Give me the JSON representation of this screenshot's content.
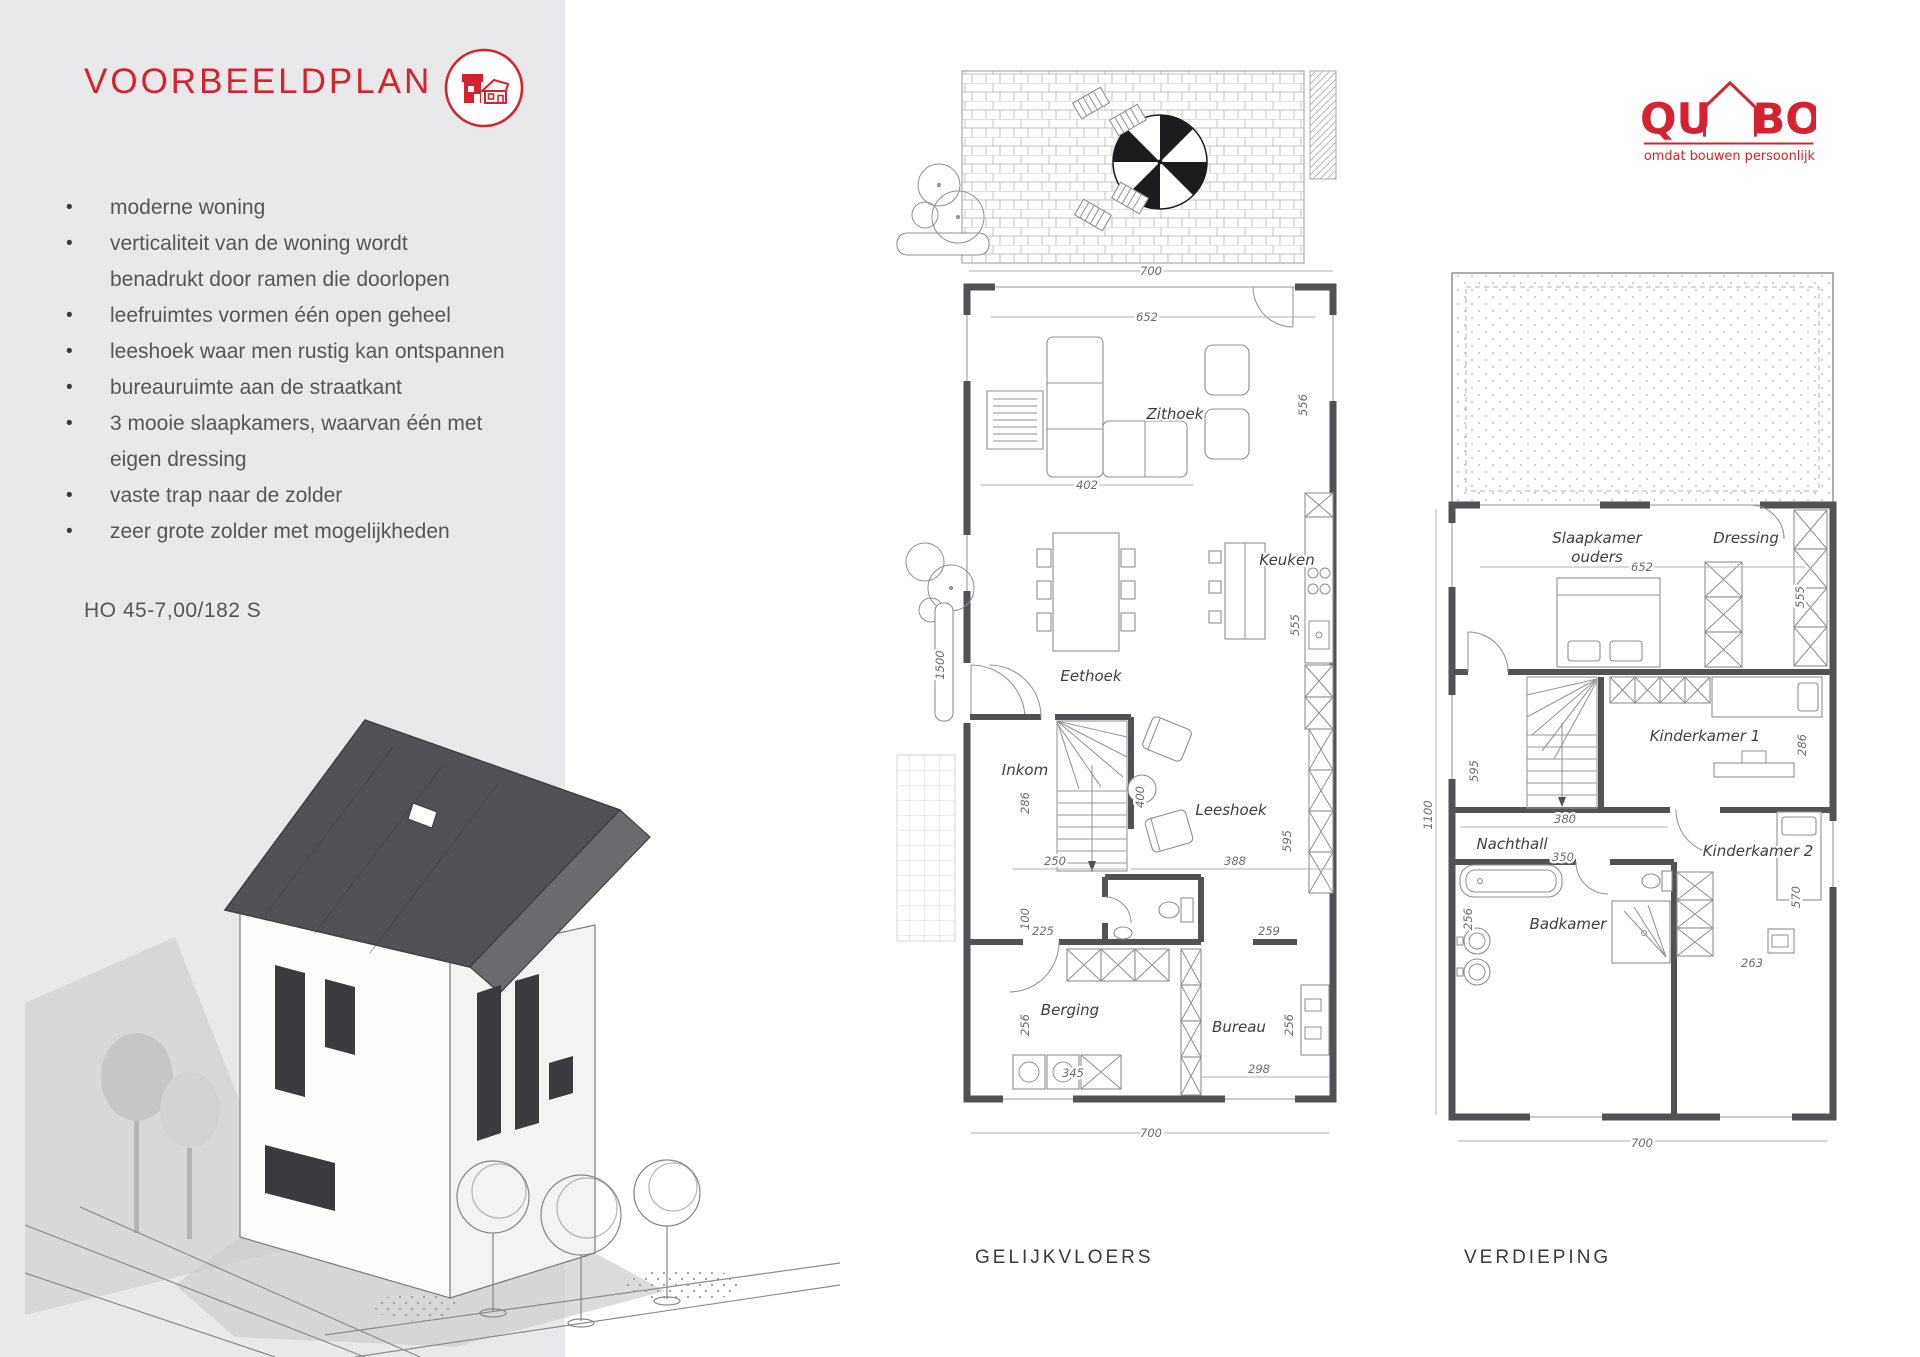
{
  "panel": {
    "title": "VOORBEELDPLAN",
    "lines": [
      {
        "bullet": "•",
        "text": "moderne woning"
      },
      {
        "bullet": "•",
        "text": "verticaliteit van de woning wordt"
      },
      {
        "bullet": "",
        "text": "benadrukt door ramen die doorlopen"
      },
      {
        "bullet": "•",
        "text": "leefruimtes vormen één open geheel"
      },
      {
        "bullet": "•",
        "text": "leeshoek waar men rustig kan ontspannen"
      },
      {
        "bullet": "•",
        "text": "bureauruimte aan de straatkant"
      },
      {
        "bullet": "•",
        "text": "3 mooie slaapkamers, waarvan één met"
      },
      {
        "bullet": "",
        "text": "eigen dressing"
      },
      {
        "bullet": "•",
        "text": "vaste trap naar de zolder"
      },
      {
        "bullet": "•",
        "text": "zeer grote zolder met mogelijkheden"
      }
    ],
    "code": "HO 45-7,00/182 S"
  },
  "logo": {
    "qu": "QU",
    "bo": "BO",
    "tagline": "omdat bouwen persoonlijk is"
  },
  "plans": {
    "ground": {
      "caption": "GELIJKVLOERS",
      "rooms": {
        "zithoek": "Zithoek",
        "keuken": "Keuken",
        "eethoek": "Eethoek",
        "inkom": "Inkom",
        "leeshoek": "Leeshoek",
        "berging": "Berging",
        "bureau": "Bureau"
      },
      "dims": {
        "terras": "700",
        "top": "652",
        "zithoek_d": "556",
        "sofa": "402",
        "keuken_d": "555",
        "oprit": "1500",
        "inkom_d": "286",
        "trap": "250",
        "gang": "100",
        "hal": "225",
        "leeshoek_w": "388",
        "wc": "259",
        "leeshoek_d": "595",
        "tafel": "400",
        "berging_d": "256",
        "was": "345",
        "bureau_d": "256",
        "bureau_w": "298",
        "breedte": "700"
      }
    },
    "upper": {
      "caption": "VERDIEPING",
      "rooms": {
        "slaapkamer_1": "Slaapkamer",
        "slaapkamer_2": "ouders",
        "dressing": "Dressing",
        "kinderkamer1": "Kinderkamer 1",
        "nachthall": "Nachthall",
        "kinderkamer2": "Kinderkamer 2",
        "badkamer": "Badkamer"
      },
      "dims": {
        "diepte": "1100",
        "slaapkamer_w": "652",
        "dressing_d": "555",
        "trap_d": "595",
        "k1_d": "286",
        "nachthall_w": "380",
        "bad_w": "350",
        "k2_d": "570",
        "badkamer_d": "256",
        "k2_w": "263",
        "breedte": "700"
      }
    }
  },
  "colors": {
    "accent": "#d4232e",
    "panel_bg": "#e9e9eb",
    "body_text": "#56565a",
    "plan_line": "#515156"
  }
}
